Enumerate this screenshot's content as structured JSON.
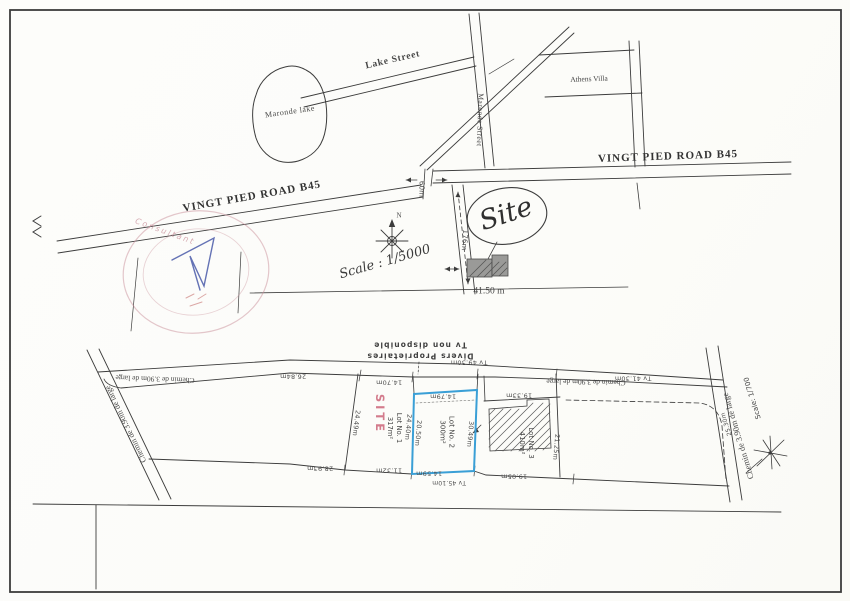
{
  "colors": {
    "ink": "#3c3c3c",
    "highlight_blue": "#3a9fd6",
    "site_red": "#c95b72",
    "stamp_pink": "#c98f9b",
    "stamp_blue": "#3d4fa4"
  },
  "location_map": {
    "lake_label": "Maronde lake",
    "lake_street": "Lake Street",
    "maronde_street": "Maronde Street",
    "road_b45": "VINGT PIED ROAD B45",
    "athens_villa": "Athens Villa",
    "site": "Site",
    "scale": "Scale : 1/5000",
    "north": "N",
    "dim_60": "60m",
    "dim_176": "176m",
    "dim_4150": "41.50 m"
  },
  "stamp": {
    "arc_text": "Consultant"
  },
  "survey_plan": {
    "owners_line1": "Divers Proprietaires",
    "owners_line2": "Tv non disponible",
    "chemin": "Chemin de 3.90m de large",
    "scale": "Scale: 1/700",
    "site_stamp": "SITE",
    "lot1": {
      "name": "Lot No. 1",
      "area": "317m²"
    },
    "lot2": {
      "name": "Lot No. 2",
      "area": "300m²"
    },
    "lot3": {
      "name": "Lot No. 3",
      "area": "410m²"
    },
    "dims": {
      "tv_4930": "Tv 49.30m",
      "tv_4130": "Tv 41.30m",
      "tv_4510": "Tv 45.10m",
      "d_1470": "14.70m",
      "d_2684": "26.84m",
      "d_2893": "28.93m",
      "d_2449": "24.49m",
      "d_1132": "11.32m",
      "d_1479": "14.79m",
      "d_2440": "24.40m",
      "d_2050": "20.50m",
      "d_3049": "30.49m",
      "d_1459": "14.59m",
      "d_1933": "19.33m",
      "d_1905": "19.05m",
      "d_2125": "21.25m",
      "d_2530": "25.30m"
    }
  }
}
